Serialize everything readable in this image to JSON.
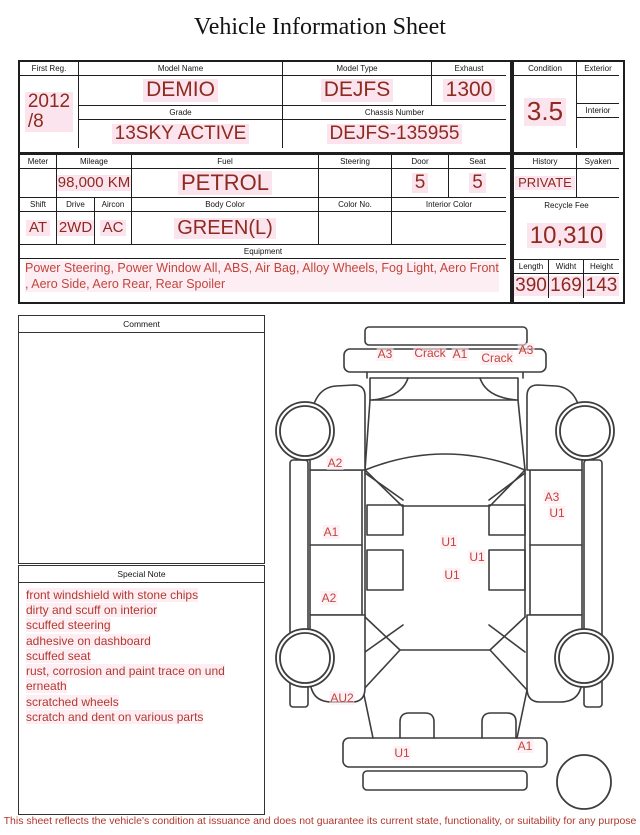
{
  "title": "Vehicle Information Sheet",
  "vehicle": {
    "first_reg_label": "First Reg.",
    "first_reg": "2012\n/8",
    "model_name_label": "Model Name",
    "model_name": "DEMIO",
    "model_type_label": "Model Type",
    "model_type": "DEJFS",
    "exhaust_label": "Exhaust",
    "exhaust": "1300",
    "grade_label": "Grade",
    "grade": "13SKY ACTIVE",
    "chassis_label": "Chassis Number",
    "chassis_number": "DEJFS-135955",
    "condition_label": "Condition",
    "condition": "3.5",
    "exterior_label": "Exterior",
    "exterior": "",
    "interior_label": "Interior",
    "interior": ""
  },
  "details": {
    "meter_label": "Meter",
    "meter": "",
    "mileage_label": "Mileage",
    "mileage": "98,000 KM",
    "fuel_label": "Fuel",
    "fuel": "PETROL",
    "steering_label": "Steering",
    "steering": "",
    "door_label": "Door",
    "door": "5",
    "seat_label": "Seat",
    "seat": "5",
    "shift_label": "Shift",
    "shift": "AT",
    "drive_label": "Drive",
    "drive": "2WD",
    "aircon_label": "Aircon",
    "aircon": "AC",
    "body_color_label": "Body Color",
    "body_color": "GREEN(L)",
    "color_no_label": "Color No.",
    "color_no": "",
    "interior_color_label": "Interior Color",
    "interior_color": "",
    "history_label": "History",
    "history": "PRIVATE",
    "syaken_label": "Syaken",
    "syaken": "",
    "recycle_fee_label": "Recycle Fee",
    "recycle_fee": "10,310",
    "length_label": "Length",
    "length": "390",
    "width_label": "Widht",
    "width": "169",
    "height_label": "Height",
    "height": "143",
    "equipment_label": "Equipment",
    "equipment": "Power Steering, Power Window  All, ABS, Air Bag, Alloy Wheels, Fog Light, Aero Front\n, Aero Side, Aero Rear, Rear Spoiler"
  },
  "comment": {
    "label": "Comment",
    "text": ""
  },
  "special_note": {
    "label": "Special Note",
    "text": "front windshield with stone chips\ndirty and scuff on interior\nscuffed steering\nadhesive on dashboard\nscuffed seat\nrust, corrosion and paint trace on und\nerneath\nscratched wheels\nscratch and dent on various parts"
  },
  "diagram": {
    "labels": [
      {
        "text": "A3",
        "x": 115,
        "y": 44
      },
      {
        "text": "Crack",
        "x": 160,
        "y": 43
      },
      {
        "text": "A1",
        "x": 190,
        "y": 44
      },
      {
        "text": "Crack",
        "x": 227,
        "y": 48
      },
      {
        "text": "A3",
        "x": 256,
        "y": 40
      },
      {
        "text": "A2",
        "x": 65,
        "y": 153
      },
      {
        "text": "A1",
        "x": 61,
        "y": 222
      },
      {
        "text": "A2",
        "x": 59,
        "y": 288
      },
      {
        "text": "U1",
        "x": 179,
        "y": 232
      },
      {
        "text": "U1",
        "x": 207,
        "y": 247
      },
      {
        "text": "U1",
        "x": 182,
        "y": 265
      },
      {
        "text": "A3",
        "x": 282,
        "y": 187
      },
      {
        "text": "U1",
        "x": 287,
        "y": 203
      },
      {
        "text": "AU2",
        "x": 72,
        "y": 388
      },
      {
        "text": "U1",
        "x": 132,
        "y": 443
      },
      {
        "text": "A1",
        "x": 255,
        "y": 436
      }
    ]
  },
  "footer": {
    "disclaimer": "This sheet reflects the vehicle's condition at issuance and does not guarantee its current state, functionality, or suitability for any purpose"
  },
  "colors": {
    "value_red": "#8e2a20",
    "note_red": "#c2453c",
    "highlight_pink": "#fbe4ee"
  }
}
